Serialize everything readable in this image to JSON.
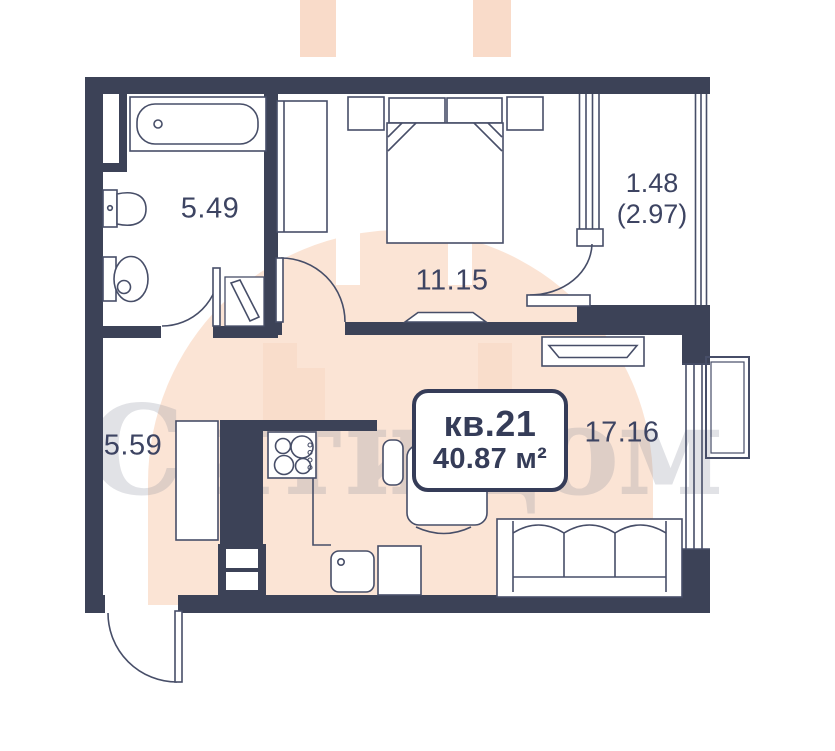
{
  "watermark": {
    "text": "СитиДом"
  },
  "unit_label": {
    "number": "кв.21",
    "area": "40.87 м²"
  },
  "rooms": {
    "bathroom": {
      "area": "5.49"
    },
    "bedroom": {
      "area": "11.15"
    },
    "balcony": {
      "area": "1.48",
      "area_total": "(2.97)"
    },
    "hallway": {
      "area": "5.59"
    },
    "living": {
      "area": "17.16"
    }
  },
  "colors": {
    "wall": "#3c4257",
    "line": "#474e68",
    "label_text": "#3d4462",
    "unit_box_border": "#353c58",
    "watermark_peach": "#fbe4d5",
    "watermark_peach_dark": "#f8d7c3",
    "watermark_gray_text": "rgba(134,138,155,0.25)"
  }
}
